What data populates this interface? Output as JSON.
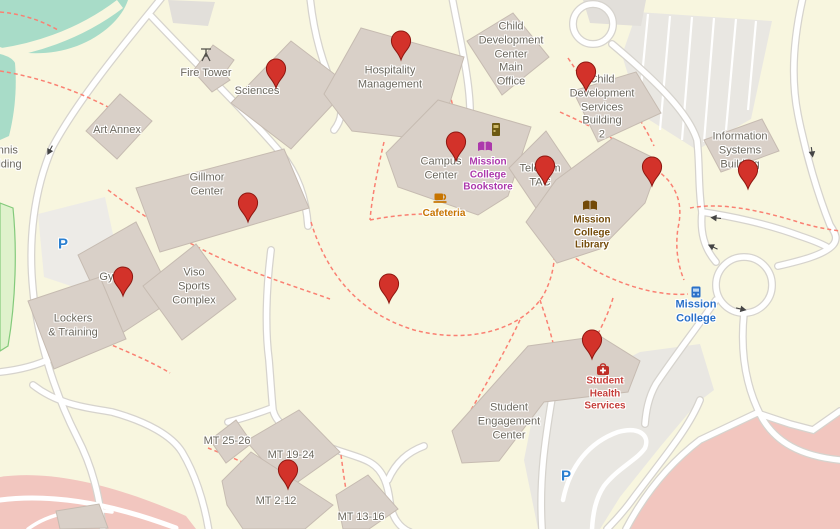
{
  "map": {
    "kind": "campus street map",
    "campus_name": "Mission College"
  },
  "labels": {
    "fire_tower": "Fire Tower",
    "sciences": "Sciences",
    "art_annex": "Art Annex",
    "tennis_building": "Tennis\nBuilding",
    "gillmor_center": "Gillmor\nCenter",
    "hospitality_management": "Hospitality\nManagement",
    "cdc_main_office": "Child\nDevelopment\nCenter\nMain\nOffice",
    "cds_building_2": "Child\nDevelopment\nServices\nBuilding\n2",
    "information_systems_building": "Information\nSystems\nBuilding",
    "campus_center": "Campus\nCenter",
    "mission_college_bookstore": "Mission\nCollege\nBookstore",
    "cafeteria": "Cafeteria",
    "telecom_tac": "Telecom\nTAC",
    "mission_college_library": "Mission\nCollege\nLibrary",
    "gym": "Gym",
    "viso_sports_complex": "Viso\nSports\nComplex",
    "lockers_training": "Lockers\n& Training",
    "student_engagement_center": "Student\nEngagement\nCenter",
    "student_health_services": "Student\nHealth\nServices",
    "mission_college_stop": "Mission\nCollege",
    "mt_25_26": "MT 25-26",
    "mt_19_24": "MT 19-24",
    "mt_2_12": "MT 2-12",
    "mt_13_16": "MT 13-16",
    "parking": "P"
  },
  "markers": {
    "count": 12,
    "glyph": "red-map-pin",
    "locations": [
      "Sciences",
      "Hospitality Management",
      "Child Development Services Building 2",
      "Campus Center",
      "Telecom TAC",
      "Mission College Library east wing",
      "Information Systems Building",
      "Gillmor Center",
      "Gym",
      "campus central open area",
      "Student Health Services",
      "MT 2-12"
    ]
  },
  "icons": {
    "fire_tower": "tower-icon",
    "vending": "vending-machine-icon",
    "bookstore": "open-book-icon",
    "cafeteria": "coffee-cup-icon",
    "library": "open-book-icon",
    "health": "first-aid-kit-icon",
    "bus_stop": "bus-stop-icon",
    "parking": "P",
    "one_way": "arrow-icon"
  },
  "colors": {
    "campus_background": "#f8f6df",
    "building_fill": "#d9d0c8",
    "building_outline": "#c6bbb1",
    "road_fill": "#ffffff",
    "road_casing": "#d6d3cd",
    "footpath_dashed": "#fa8072",
    "pitch_teal": "#a8dcc8",
    "pitch_green": "#dff2cc",
    "track_pink": "#f2c6bf",
    "parking_lot_gray": "#e9e7e2",
    "marker_red": "#d3322a",
    "poi_purple": "#ac39ac",
    "poi_amber": "#c77400",
    "poi_brown": "#734a08",
    "poi_red": "#c6403c",
    "transit_blue": "#2a70c8",
    "label_gray": "#6b675d"
  }
}
